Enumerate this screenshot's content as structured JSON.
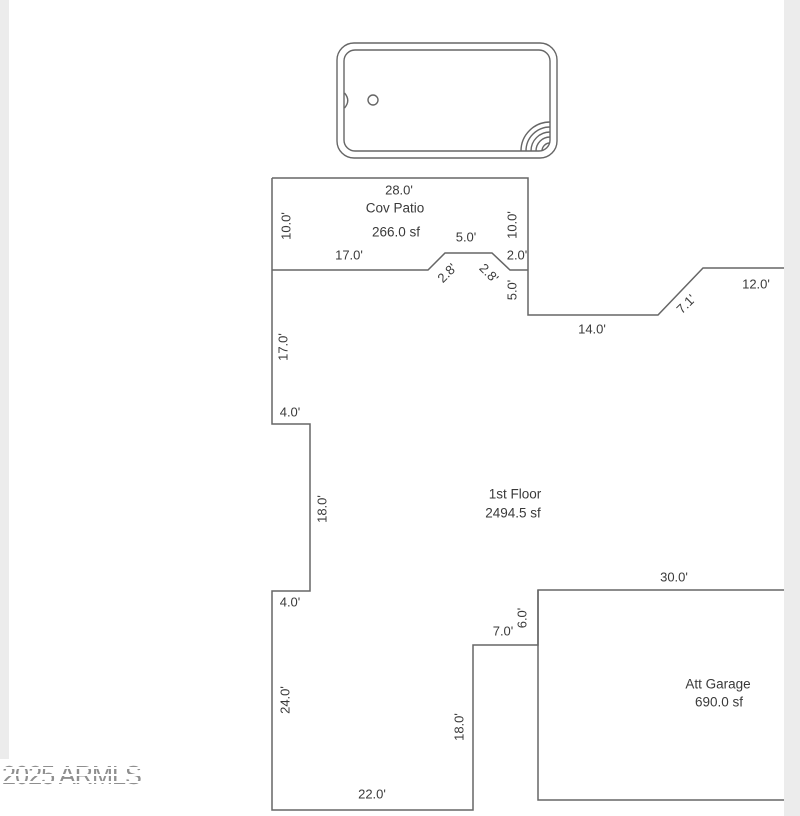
{
  "plan": {
    "areas": {
      "patio": {
        "label": "Cov Patio",
        "sqft": "266.0 sf"
      },
      "first_floor": {
        "label": "1st Floor",
        "sqft": "2494.5 sf"
      },
      "garage": {
        "label": "Att Garage",
        "sqft": "690.0 sf"
      }
    },
    "dims": {
      "patio_top": "28.0'",
      "patio_left": "10.0'",
      "patio_right": "10.0'",
      "patio_inner": "17.0'",
      "bump_top": "5.0'",
      "bump_left": "2.8'",
      "bump_right": "2.8'",
      "right_step": "2.0'",
      "right_down": "5.0'",
      "right_bottom": "14.0'",
      "right_diag": "7.1'",
      "right_top": "12.0'",
      "left_upper": "17.0'",
      "left_jog_upper": "4.0'",
      "left_mid": "18.0'",
      "left_jog_lower": "4.0'",
      "left_lower": "24.0'",
      "bottom": "22.0'",
      "notch_right": "18.0'",
      "notch_top": "7.0'",
      "garage_left": "6.0'",
      "garage_top": "30.0'"
    },
    "watermark": "2025 ARMLS",
    "colors": {
      "wall": "#666666",
      "text": "#3a3a3a",
      "page_edge": "#ececec",
      "watermark": "#8f8f8f"
    }
  }
}
